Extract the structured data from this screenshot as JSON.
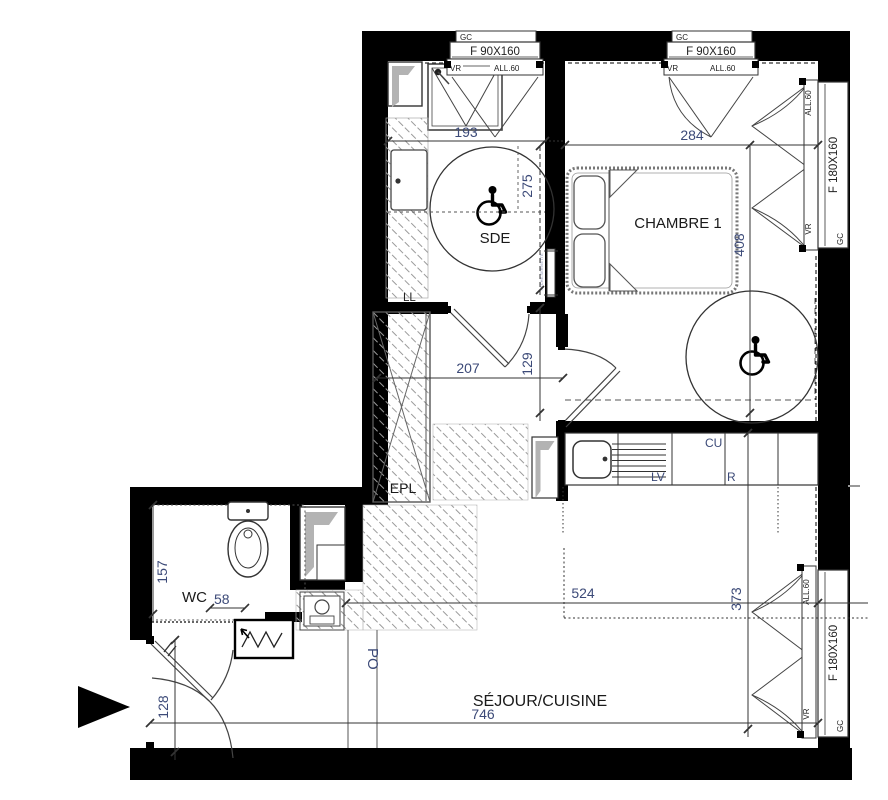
{
  "plan": {
    "rooms": {
      "sde": "SDE",
      "chambre": "CHAMBRE 1",
      "wc": "WC",
      "sejour": "SÉJOUR/CUISINE",
      "epl": "EPL"
    },
    "appliances": {
      "ll": "LL",
      "lv": "LV",
      "cu": "CU",
      "r": "R",
      "po": "PO",
      "seche_serviette": "SECHE-SERVIETTE"
    },
    "windows": {
      "gc": "GC",
      "vr": "VR",
      "all60": "ALL.60",
      "f90": "F 90X160",
      "f180": "F 180X160"
    },
    "dimensions": {
      "sde_w": "193",
      "sde_h": "275",
      "chambre_w": "284",
      "chambre_h": "408",
      "hall_w": "207",
      "hall_h": "129",
      "wc_h": "157",
      "wc_d": "58",
      "sejour_inner_w": "524",
      "sejour_h": "373",
      "sejour_w": "746",
      "entry_h": "128"
    },
    "colors": {
      "wall": "#000000",
      "dim_text": "#3c4a78",
      "room_text": "#1a1a1a",
      "hatch": "#9a9a9a",
      "shaft_gray": "#b3b3b3"
    }
  }
}
